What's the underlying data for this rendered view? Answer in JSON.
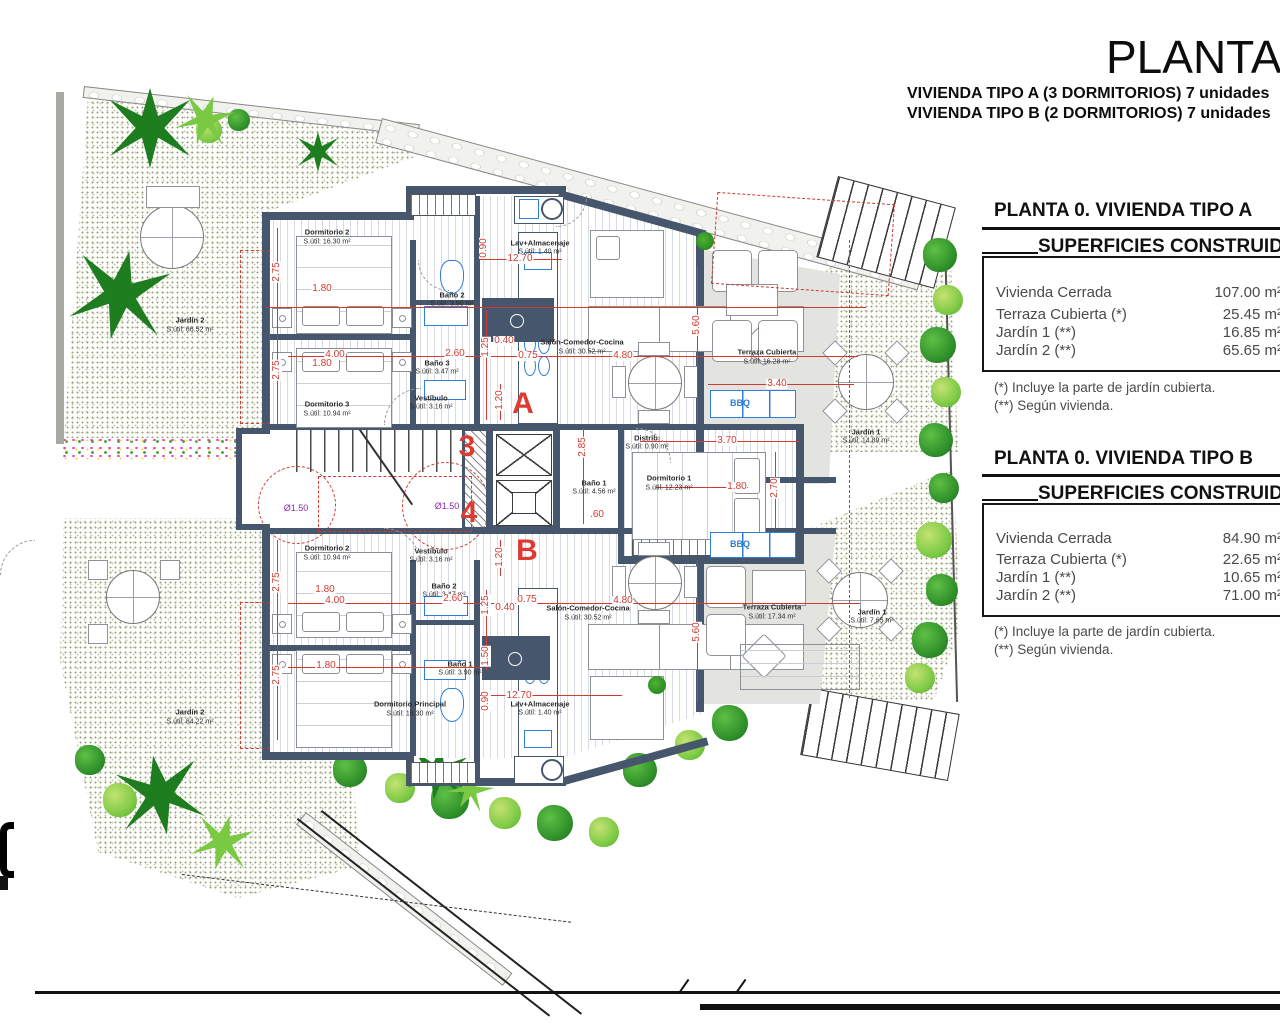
{
  "header": {
    "title": "PLANTA 0",
    "subtitle_a": "VIVIENDA TIPO A (3 DORMITORIOS) 7 unidades",
    "subtitle_b": "VIVIENDA TIPO B (2 DORMITORIOS) 7 unidades"
  },
  "panel_a": {
    "heading": "PLANTA 0. VIVIENDA TIPO A",
    "table_title": "SUPERFICIES CONSTRUIDAS",
    "rows": [
      {
        "label": "Vivienda Cerrada",
        "value": "107.00 m²"
      },
      {
        "label": "Terraza Cubierta  (*)",
        "value": "25.45 m²"
      },
      {
        "label": "Jardín 1 (**)",
        "value": "16.85 m²"
      },
      {
        "label": "Jardín 2 (**)",
        "value": "65.65 m²"
      }
    ],
    "note1": "(*)  Incluye la parte de jardín cubierta.",
    "note2": "(**) Según vivienda."
  },
  "panel_b": {
    "heading": "PLANTA 0. VIVIENDA TIPO B",
    "table_title": "SUPERFICIES CONSTRUIDAS",
    "rows": [
      {
        "label": "Vivienda Cerrada",
        "value": "84.90 m²"
      },
      {
        "label": "Terraza Cubierta (*)",
        "value": "22.65 m²"
      },
      {
        "label": "Jardín 1 (**)",
        "value": "10.65 m²"
      },
      {
        "label": "Jardín 2 (**)",
        "value": "71.00 m²"
      }
    ],
    "note1": "(*) Incluye la parte de jardín cubierta.",
    "note2": "(**) Según vivienda."
  },
  "plan": {
    "labels": [
      {
        "t": "Dormitorio 2",
        "x": 327,
        "y": 232,
        "c": "rm",
        "n": "room-label"
      },
      {
        "t": "S.útil: 16.30 m²",
        "x": 327,
        "y": 242,
        "c": "rma",
        "n": "area-label"
      },
      {
        "t": "Dormitorio 3",
        "x": 327,
        "y": 404,
        "c": "rm",
        "n": "room-label"
      },
      {
        "t": "S.útil: 10.94 m²",
        "x": 327,
        "y": 414,
        "c": "rma",
        "n": "area-label"
      },
      {
        "t": "Baño 2",
        "x": 452,
        "y": 295,
        "c": "rm",
        "n": "room-label"
      },
      {
        "t": "S.útil: 3.90 m²",
        "x": 452,
        "y": 304,
        "c": "rma",
        "n": "area-label"
      },
      {
        "t": "Baño 3",
        "x": 437,
        "y": 363,
        "c": "rm",
        "n": "room-label"
      },
      {
        "t": "S.útil: 3.47 m²",
        "x": 437,
        "y": 372,
        "c": "rma",
        "n": "area-label"
      },
      {
        "t": "Lav+Almacenaje",
        "x": 540,
        "y": 243,
        "c": "rm",
        "n": "room-label"
      },
      {
        "t": "S.útil: 1.40 m²",
        "x": 540,
        "y": 252,
        "c": "rma",
        "n": "area-label"
      },
      {
        "t": "Salón-Comedor-Cocina",
        "x": 582,
        "y": 342,
        "c": "rm",
        "n": "room-label"
      },
      {
        "t": "S.útil: 30.52 m²",
        "x": 582,
        "y": 352,
        "c": "rma",
        "n": "area-label"
      },
      {
        "t": "Vestíbulo",
        "x": 431,
        "y": 398,
        "c": "rm",
        "n": "room-label"
      },
      {
        "t": "S.útil: 3.16 m²",
        "x": 431,
        "y": 407,
        "c": "rma",
        "n": "area-label"
      },
      {
        "t": "Distrib.",
        "x": 647,
        "y": 438,
        "c": "rm",
        "n": "room-label"
      },
      {
        "t": "S.útil: 0.90 m²",
        "x": 647,
        "y": 447,
        "c": "rma",
        "n": "area-label"
      },
      {
        "t": "Baño 1",
        "x": 594,
        "y": 483,
        "c": "rm",
        "n": "room-label"
      },
      {
        "t": "S.útil: 4.56 m²",
        "x": 594,
        "y": 492,
        "c": "rma",
        "n": "area-label"
      },
      {
        "t": "Dormitorio 1",
        "x": 669,
        "y": 478,
        "c": "rm",
        "n": "room-label"
      },
      {
        "t": "S.útil: 12.23 m²",
        "x": 669,
        "y": 488,
        "c": "rma",
        "n": "area-label"
      },
      {
        "t": "Terraza Cubierta",
        "x": 767,
        "y": 352,
        "c": "rm",
        "n": "room-label"
      },
      {
        "t": "S.útil: 16.28 m²",
        "x": 767,
        "y": 362,
        "c": "rma",
        "n": "area-label"
      },
      {
        "t": "Jardín 1",
        "x": 866,
        "y": 432,
        "c": "rm",
        "n": "room-label"
      },
      {
        "t": "S.útil: 14.89 m²",
        "x": 866,
        "y": 441,
        "c": "rma",
        "n": "area-label"
      },
      {
        "t": "Jardín 2",
        "x": 190,
        "y": 320,
        "c": "rm",
        "n": "room-label"
      },
      {
        "t": "S.útil: 66.52 m²",
        "x": 190,
        "y": 330,
        "c": "rma",
        "n": "area-label"
      },
      {
        "t": "Dormitorio 2",
        "x": 327,
        "y": 548,
        "c": "rm",
        "n": "room-label"
      },
      {
        "t": "S.útil: 10.94 m²",
        "x": 327,
        "y": 558,
        "c": "rma",
        "n": "area-label"
      },
      {
        "t": "Vestíbulo",
        "x": 431,
        "y": 551,
        "c": "rm",
        "n": "room-label"
      },
      {
        "t": "S.útil: 3.16 m²",
        "x": 431,
        "y": 560,
        "c": "rma",
        "n": "area-label"
      },
      {
        "t": "Baño 2",
        "x": 444,
        "y": 586,
        "c": "rm",
        "n": "room-label"
      },
      {
        "t": "S.útil: 3.47 m²",
        "x": 444,
        "y": 595,
        "c": "rma",
        "n": "area-label"
      },
      {
        "t": "Baño 1",
        "x": 460,
        "y": 664,
        "c": "rm",
        "n": "room-label"
      },
      {
        "t": "S.útil: 3.90 m²",
        "x": 460,
        "y": 673,
        "c": "rma",
        "n": "area-label"
      },
      {
        "t": "Dormitorio Principal",
        "x": 410,
        "y": 704,
        "c": "rm",
        "n": "room-label"
      },
      {
        "t": "S.útil: 16.30 m²",
        "x": 410,
        "y": 714,
        "c": "rma",
        "n": "area-label"
      },
      {
        "t": "Salón-Comedor-Cocina",
        "x": 588,
        "y": 608,
        "c": "rm",
        "n": "room-label"
      },
      {
        "t": "S.útil: 30.52 m²",
        "x": 588,
        "y": 618,
        "c": "rma",
        "n": "area-label"
      },
      {
        "t": "Lav+Almacenaje",
        "x": 540,
        "y": 704,
        "c": "rm",
        "n": "room-label"
      },
      {
        "t": "S.útil: 1.40 m²",
        "x": 540,
        "y": 713,
        "c": "rma",
        "n": "area-label"
      },
      {
        "t": "Terraza Cubierta",
        "x": 772,
        "y": 607,
        "c": "rm",
        "n": "room-label"
      },
      {
        "t": "S.útil: 17.34 m²",
        "x": 772,
        "y": 617,
        "c": "rma",
        "n": "area-label"
      },
      {
        "t": "Jardín 1",
        "x": 872,
        "y": 612,
        "c": "rm",
        "n": "room-label"
      },
      {
        "t": "S.útil: 7.65 m²",
        "x": 872,
        "y": 621,
        "c": "rma",
        "n": "area-label"
      },
      {
        "t": "Jardín 2",
        "x": 190,
        "y": 712,
        "c": "rm",
        "n": "room-label"
      },
      {
        "t": "S.útil: 84.22 m²",
        "x": 190,
        "y": 722,
        "c": "rma",
        "n": "area-label"
      },
      {
        "t": "A",
        "x": 523,
        "y": 404,
        "c": "ltr",
        "n": "unit-letter"
      },
      {
        "t": "B",
        "x": 527,
        "y": 551,
        "c": "ltr",
        "n": "unit-letter"
      },
      {
        "t": "3",
        "x": 467,
        "y": 447,
        "c": "ltr",
        "n": "portal-number"
      },
      {
        "t": "4",
        "x": 469,
        "y": 513,
        "c": "ltr",
        "n": "portal-number"
      },
      {
        "t": "Ø1.50",
        "x": 296,
        "y": 508,
        "c": "dia",
        "n": "diameter-label"
      },
      {
        "t": "Ø1.50",
        "x": 447,
        "y": 506,
        "c": "dia",
        "n": "diameter-label"
      },
      {
        "t": "BBQ",
        "x": 740,
        "y": 403,
        "c": "bbq",
        "n": "bbq-label"
      },
      {
        "t": "BBQ",
        "x": 740,
        "y": 544,
        "c": "bbq",
        "n": "bbq-label"
      },
      {
        "t": "2.75",
        "x": 277,
        "y": 272,
        "c": "dim",
        "r": -90,
        "n": "dimension-label"
      },
      {
        "t": "1.80",
        "x": 322,
        "y": 289,
        "c": "dim",
        "n": "dimension-label"
      },
      {
        "t": "4.00",
        "x": 335,
        "y": 355,
        "c": "dim",
        "n": "dimension-label"
      },
      {
        "t": "1.80",
        "x": 322,
        "y": 364,
        "c": "dim",
        "n": "dimension-label"
      },
      {
        "t": "2.75",
        "x": 277,
        "y": 370,
        "c": "dim",
        "r": -90,
        "n": "dimension-label"
      },
      {
        "t": "2.60",
        "x": 455,
        "y": 354,
        "c": "dim",
        "n": "dimension-label"
      },
      {
        "t": "0.90",
        "x": 484,
        "y": 248,
        "c": "dim",
        "r": -90,
        "n": "dimension-label"
      },
      {
        "t": "12.70",
        "x": 520,
        "y": 259,
        "c": "dim",
        "n": "dimension-label"
      },
      {
        "t": "1.25",
        "x": 486,
        "y": 347,
        "c": "dim",
        "r": -90,
        "n": "dimension-label"
      },
      {
        "t": "0.40",
        "x": 504,
        "y": 341,
        "c": "dim",
        "n": "dimension-label"
      },
      {
        "t": "0.75",
        "x": 528,
        "y": 356,
        "c": "dim",
        "n": "dimension-label"
      },
      {
        "t": "4.80",
        "x": 623,
        "y": 356,
        "c": "dim",
        "n": "dimension-label"
      },
      {
        "t": "5.60",
        "x": 697,
        "y": 325,
        "c": "dim",
        "r": -90,
        "n": "dimension-label"
      },
      {
        "t": "3.40",
        "x": 777,
        "y": 384,
        "c": "dim",
        "n": "dimension-label"
      },
      {
        "t": "3.70",
        "x": 727,
        "y": 441,
        "c": "dim",
        "n": "dimension-label"
      },
      {
        "t": "2.85",
        "x": 583,
        "y": 447,
        "c": "dim",
        "r": -90,
        "n": "dimension-label"
      },
      {
        "t": ".60",
        "x": 597,
        "y": 515,
        "c": "dim",
        "n": "dimension-label"
      },
      {
        "t": "1.80",
        "x": 737,
        "y": 487,
        "c": "dim",
        "n": "dimension-label"
      },
      {
        "t": "2.70",
        "x": 775,
        "y": 488,
        "c": "dim",
        "r": -90,
        "n": "dimension-label"
      },
      {
        "t": "1.20",
        "x": 500,
        "y": 400,
        "c": "dim",
        "r": -90,
        "n": "dimension-label"
      },
      {
        "t": "1.20",
        "x": 500,
        "y": 557,
        "c": "dim",
        "r": -90,
        "n": "dimension-label"
      },
      {
        "t": "2.75",
        "x": 277,
        "y": 582,
        "c": "dim",
        "r": -90,
        "n": "dimension-label"
      },
      {
        "t": "1.80",
        "x": 325,
        "y": 590,
        "c": "dim",
        "n": "dimension-label"
      },
      {
        "t": "4.00",
        "x": 335,
        "y": 601,
        "c": "dim",
        "n": "dimension-label"
      },
      {
        "t": "2.60",
        "x": 453,
        "y": 599,
        "c": "dim",
        "n": "dimension-label"
      },
      {
        "t": "1.25",
        "x": 486,
        "y": 605,
        "c": "dim",
        "r": -90,
        "n": "dimension-label"
      },
      {
        "t": "0.40",
        "x": 505,
        "y": 608,
        "c": "dim",
        "n": "dimension-label"
      },
      {
        "t": "0.75",
        "x": 527,
        "y": 600,
        "c": "dim",
        "n": "dimension-label"
      },
      {
        "t": "4.80",
        "x": 623,
        "y": 601,
        "c": "dim",
        "n": "dimension-label"
      },
      {
        "t": "5.60",
        "x": 697,
        "y": 632,
        "c": "dim",
        "r": -90,
        "n": "dimension-label"
      },
      {
        "t": "1.50",
        "x": 486,
        "y": 656,
        "c": "dim",
        "r": -90,
        "n": "dimension-label"
      },
      {
        "t": "1.80",
        "x": 326,
        "y": 666,
        "c": "dim",
        "n": "dimension-label"
      },
      {
        "t": "2.75",
        "x": 277,
        "y": 675,
        "c": "dim",
        "r": -90,
        "n": "dimension-label"
      },
      {
        "t": "12.70",
        "x": 519,
        "y": 696,
        "c": "dim",
        "n": "dimension-label"
      },
      {
        "t": "0.90",
        "x": 486,
        "y": 701,
        "c": "dim",
        "r": -90,
        "n": "dimension-label"
      }
    ]
  }
}
